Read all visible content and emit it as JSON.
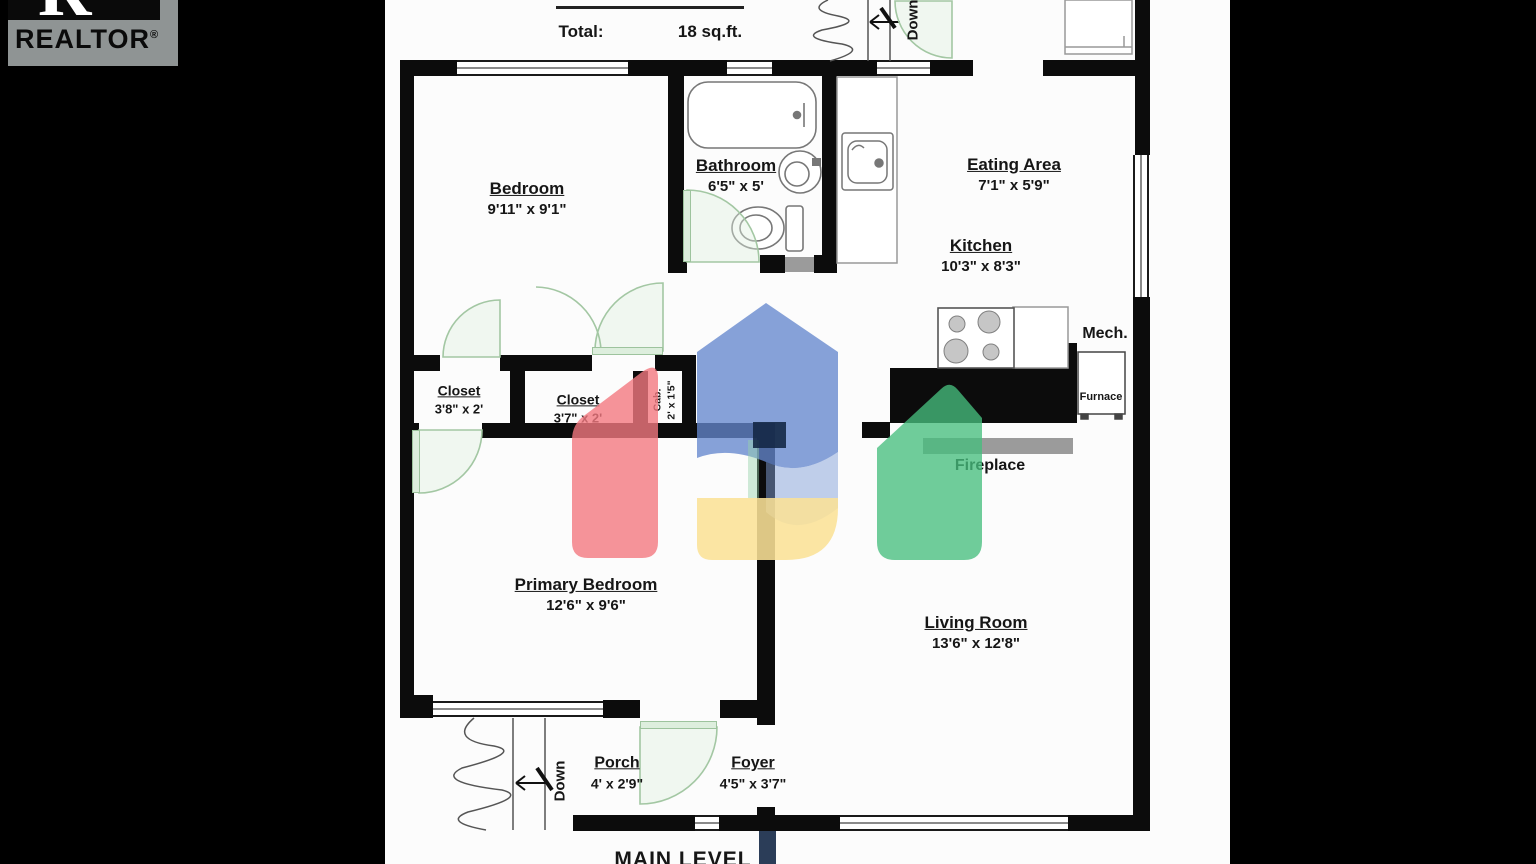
{
  "logo": {
    "r": "R",
    "name": "REALTOR",
    "reg": "®"
  },
  "legend": {
    "total_label": "Total:",
    "total_value": "18 sq.ft."
  },
  "level_label": "MAIN LEVEL",
  "rooms": {
    "bedroom": {
      "name": "Bedroom",
      "dims": "9'11\" x 9'1\""
    },
    "bathroom": {
      "name": "Bathroom",
      "dims": "6'5\" x 5'"
    },
    "eating_area": {
      "name": "Eating Area",
      "dims": "7'1\" x 5'9\""
    },
    "kitchen": {
      "name": "Kitchen",
      "dims": "10'3\" x 8'3\""
    },
    "mech": {
      "name": "Mech."
    },
    "furnace": {
      "name": "Furnace"
    },
    "closet_left": {
      "name": "Closet",
      "dims": "3'8\" x 2'"
    },
    "closet_mid": {
      "name": "Closet",
      "dims": "3'7\" x 2'"
    },
    "cabinet": {
      "name": "Cab.",
      "dims": "2' x 1'5\""
    },
    "fireplace": {
      "name": "Fireplace"
    },
    "primary_bedroom": {
      "name": "Primary Bedroom",
      "dims": "12'6\" x 9'6\""
    },
    "living_room": {
      "name": "Living Room",
      "dims": "13'6\" x 12'8\""
    },
    "porch": {
      "name": "Porch",
      "dims": "4' x 2'9\""
    },
    "foyer": {
      "name": "Foyer",
      "dims": "4'5\" x 3'7\""
    }
  },
  "stairs": {
    "down_top": "Down",
    "down_porch": "Down"
  },
  "colors": {
    "background": "#000000",
    "sheet": "#fcfcfc",
    "wall": "#0c0c0c",
    "door_green": "#9dc39d",
    "hearth_gray": "#9b9b9b",
    "logo_gray": "#8f9494",
    "watermark_red": "#f27880",
    "watermark_blue": "#6487cd",
    "watermark_yellow": "#fae196",
    "watermark_green": "#46be7d",
    "watermark_navy": "#142846"
  }
}
